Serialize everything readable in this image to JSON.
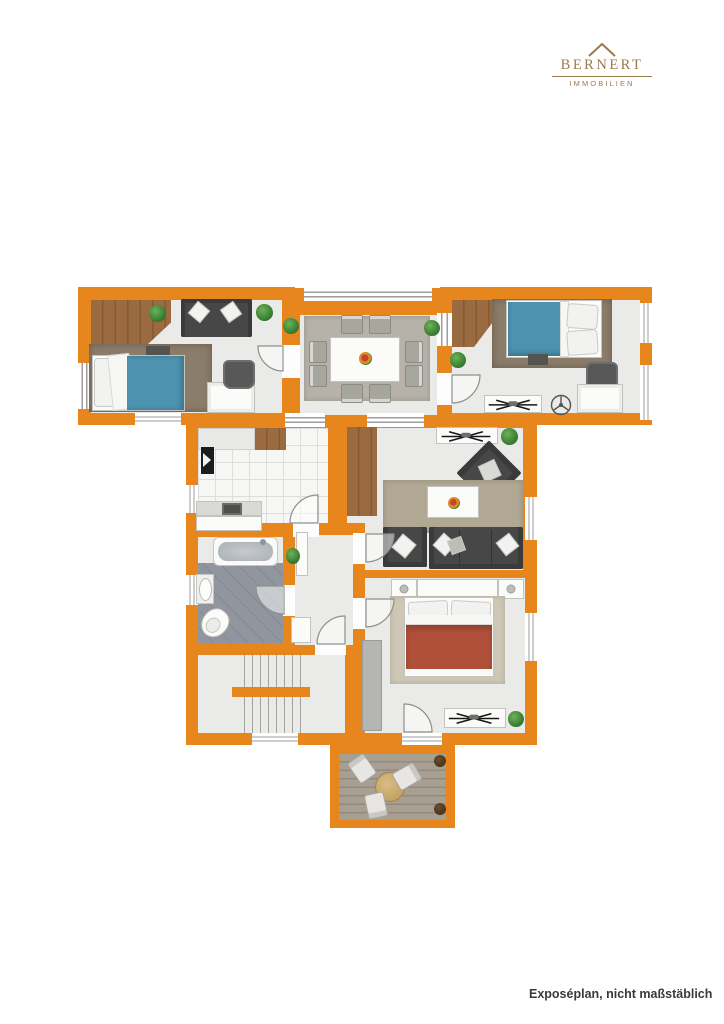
{
  "header": {
    "logo": {
      "name": "BERNERT",
      "subtitle": "IMMOBILIEN",
      "icon": "roof-icon"
    }
  },
  "footer": {
    "caption": "Exposéplan, nicht maßstäblich"
  },
  "colors": {
    "wall": "#E8861E",
    "floor": "#EAEAE8",
    "brand": "#9B7B4B",
    "bedblue": "#4D92AE",
    "bedred": "#B0503A",
    "sofadark": "#474747",
    "caption": "#3A3A3A"
  },
  "floorplan": {
    "type": "apartment-floor-plan",
    "rooms": [
      {
        "id": "bedroom-left",
        "furniture": [
          "sofa",
          "single-bed-blue",
          "desk",
          "desk-chair",
          "rug",
          "plants",
          "wood-floor-patch"
        ]
      },
      {
        "id": "dining-room",
        "furniture": [
          "dining-table",
          "eight-chairs",
          "rug",
          "flower-centerpiece",
          "plants"
        ]
      },
      {
        "id": "bedroom-right",
        "furniture": [
          "single-bed-blue",
          "desk",
          "desk-chair",
          "side-table-with-model",
          "ceiling-fan-symbol",
          "rug",
          "plant"
        ]
      },
      {
        "id": "kitchen",
        "furniture": [
          "counter",
          "wood-cabinet",
          "refrigerator",
          "sink"
        ]
      },
      {
        "id": "living-room",
        "furniture": [
          "sofa",
          "armchairs",
          "coffee-table",
          "sideboard-with-model",
          "rug",
          "wood-cabinet",
          "plants"
        ]
      },
      {
        "id": "hallway",
        "furniture": [
          "cabinets",
          "plant"
        ]
      },
      {
        "id": "bathroom",
        "furniture": [
          "bathtub",
          "washbasin",
          "toilet"
        ]
      },
      {
        "id": "staircase",
        "furniture": [
          "stairs"
        ]
      },
      {
        "id": "master-bedroom",
        "furniture": [
          "double-bed-red",
          "nightstands",
          "wardrobe",
          "side-table-with-model",
          "plant",
          "rug"
        ]
      },
      {
        "id": "terrace",
        "furniture": [
          "round-table",
          "three-chairs",
          "planter-pots",
          "wood-deck"
        ]
      }
    ]
  }
}
